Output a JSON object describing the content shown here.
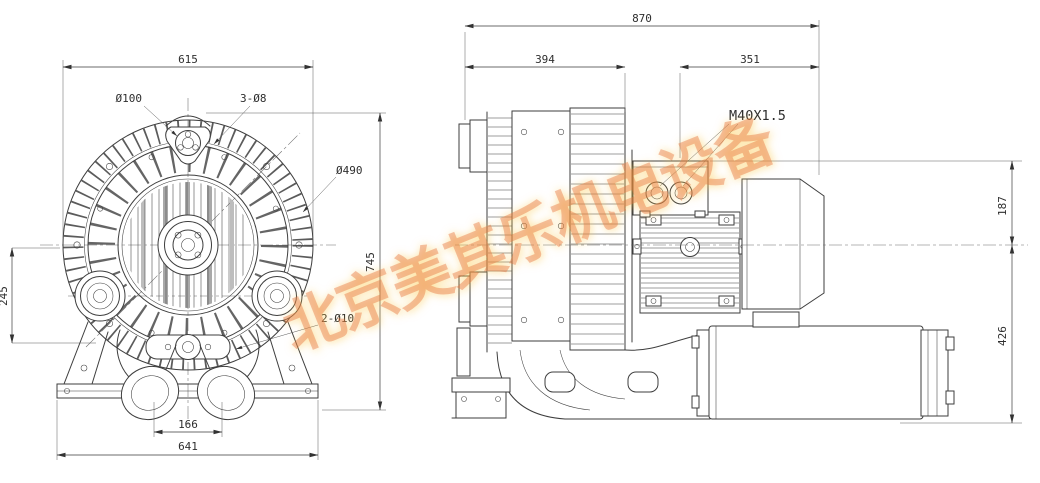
{
  "watermark": {
    "text": "北京美其乐机电设备",
    "color": "#e8703a"
  },
  "front_view": {
    "dims": {
      "overall_width": "615",
      "boss_circle": "Ø100",
      "boss_holes": "3-Ø8",
      "housing_dia": "Ø490",
      "overall_height": "745",
      "port_center_height": "245",
      "outlet_spacing": "166",
      "base_width": "641",
      "base_holes": "2-Ø10"
    }
  },
  "side_view": {
    "dims": {
      "overall_length": "870",
      "housing_length": "394",
      "motor_length": "351",
      "cable_gland_thread": "M40X1.5",
      "upper_offset": "187",
      "lower_offset": "426"
    }
  }
}
